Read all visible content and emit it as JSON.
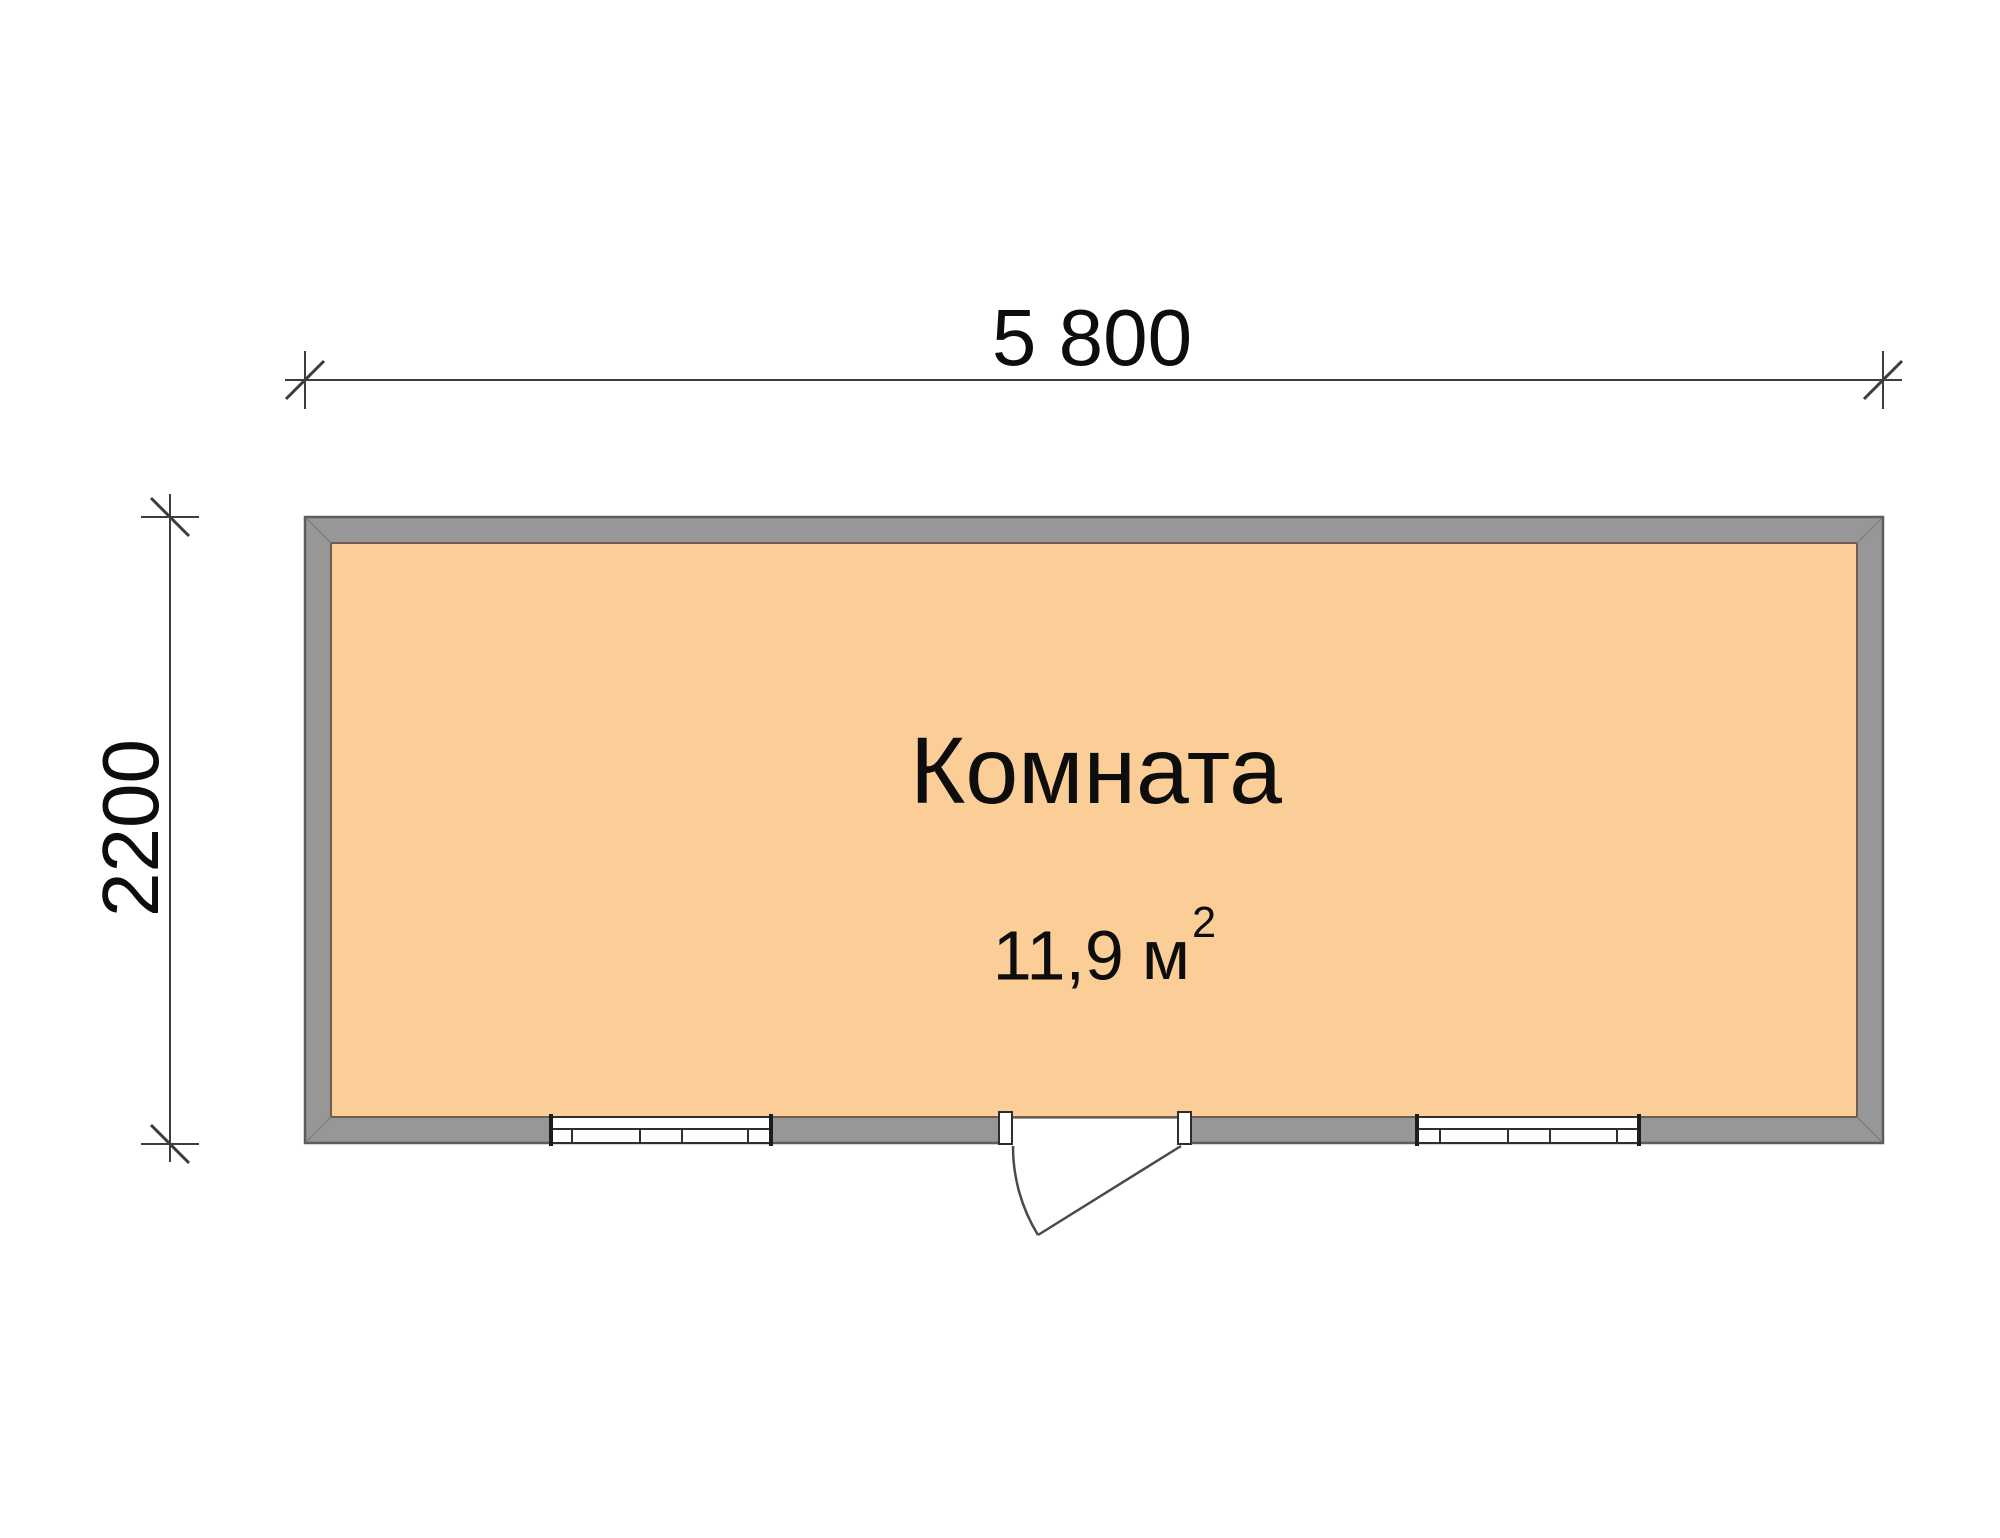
{
  "plan": {
    "room": {
      "name": "Комната",
      "area_value": "11,9",
      "area_unit": "м",
      "area_exponent": "2"
    },
    "dimensions": {
      "width_label": "5 800",
      "height_label": "2200"
    },
    "colors": {
      "background": "#ffffff",
      "wall_fill": "#979797",
      "wall_edge": "#5c5c5c",
      "floor_fill": "#FBCD97",
      "floor_edge": "#6e5b51",
      "opening_line": "#2e2e2e",
      "dim_line": "#3d3d3d",
      "text": "#0d0d0d"
    }
  }
}
